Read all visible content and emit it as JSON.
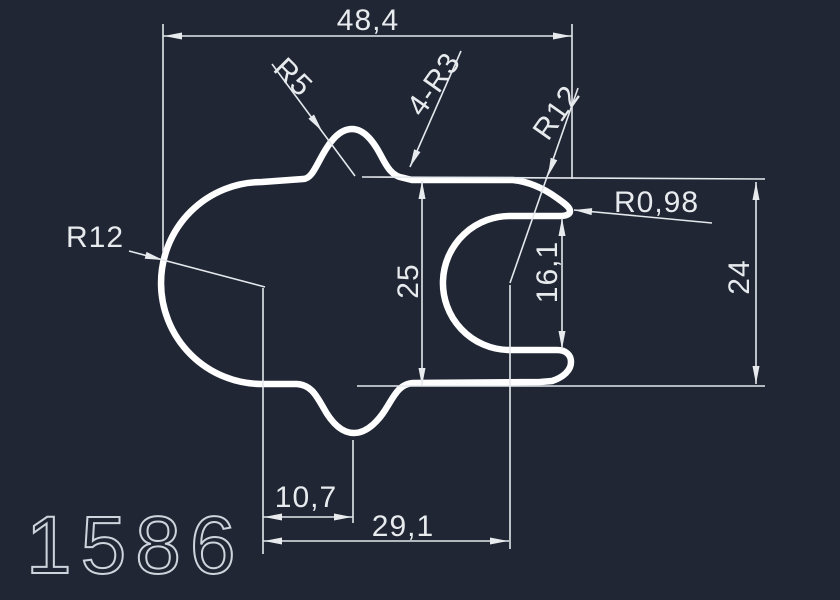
{
  "canvas": {
    "width": 840,
    "height": 600,
    "background": "#202634"
  },
  "colors": {
    "profile_stroke": "#ffffff",
    "dimension_stroke": "#e4e8ec",
    "dimension_text": "#e8ebee",
    "part_number_stroke": "#cdd4db"
  },
  "drawing": {
    "part_number": "1586",
    "dimensions": {
      "overall_width": "48,4",
      "top_bump_radius": "R5",
      "corner_fillets": "4-R3",
      "hook_outer_radius": "R12",
      "hook_tip_radius": "R0,98",
      "left_side_radius": "R12",
      "overall_height": "25",
      "channel_opening_height": "16,1",
      "right_side_height": "24",
      "bump_center_offset": "10,7",
      "channel_center_offset": "29,1"
    }
  }
}
